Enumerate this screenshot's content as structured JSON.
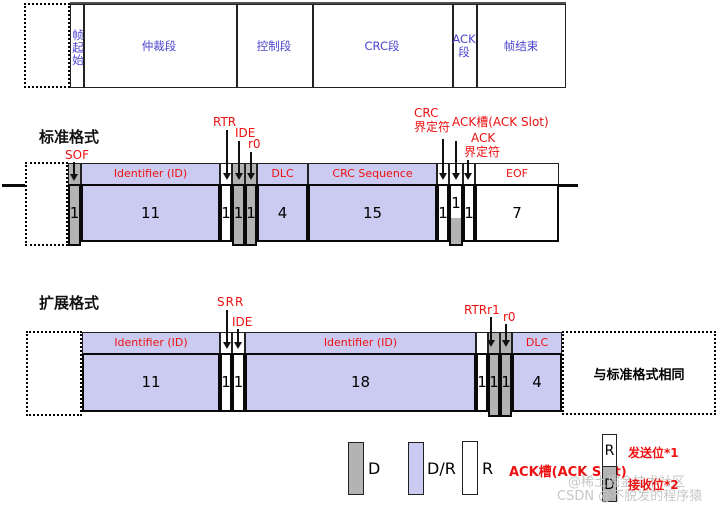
{
  "colors": {
    "dominant_fill": "#b3b3b3",
    "dominant_recessive_fill": "#cbcaf0",
    "recessive_fill": "#ffffff",
    "callout_red": "#ed1111",
    "segment_blue": "#4a43cd"
  },
  "top_frame_row": {
    "segments": [
      {
        "label": "帧起始"
      },
      {
        "label": "仲裁段"
      },
      {
        "label": "控制段"
      },
      {
        "label": "CRC段"
      },
      {
        "label": "ACK段"
      },
      {
        "label": "帧结束"
      }
    ]
  },
  "standard_format": {
    "title": "标准格式",
    "callouts": {
      "sof": "SOF",
      "rtr": "RTR",
      "ide": "IDE",
      "r0": "r0",
      "crc_delim_line1": "CRC",
      "crc_delim_line2": "界定符",
      "ack_slot": "ACK槽(ACK Slot)",
      "ack_delim_line1": "ACK",
      "ack_delim_line2": "界定符"
    },
    "fields": [
      {
        "bits": "1"
      },
      {
        "name": "Identifier (ID)",
        "bits": "11"
      },
      {
        "bits": "1"
      },
      {
        "bits": "1"
      },
      {
        "bits": "1"
      },
      {
        "name": "DLC",
        "bits": "4"
      },
      {
        "name": "CRC Sequence",
        "bits": "15"
      },
      {
        "bits": "1"
      },
      {
        "bits": "1"
      },
      {
        "bits": "1"
      },
      {
        "name": "EOF",
        "bits": "7"
      }
    ]
  },
  "extended_format": {
    "title": "扩展格式",
    "callouts": {
      "srr": "SRR",
      "ide": "IDE",
      "rtr_r1": "RTRr1",
      "r0": "r0"
    },
    "fields": [
      {
        "name": "Identifier (ID)",
        "bits": "11"
      },
      {
        "bits": "1"
      },
      {
        "bits": "1"
      },
      {
        "name": "Identifier (ID)",
        "bits": "18"
      },
      {
        "bits": "1"
      },
      {
        "bits": "1"
      },
      {
        "bits": "1"
      },
      {
        "name": "DLC",
        "bits": "4"
      }
    ],
    "same_as_standard": "与标准格式相同"
  },
  "legend": {
    "dominant": "D",
    "dual": "D/R",
    "recessive": "R",
    "ack_slot": "ACK槽(ACK Slot)",
    "stack_top": "R",
    "stack_bottom": "D",
    "transmit_note": "发送位*1",
    "receive_note": "接收位*2"
  },
  "watermarks": {
    "line1": "@稀土掘金技术社区",
    "line2": "CSDN @不脱发的程序猿"
  }
}
